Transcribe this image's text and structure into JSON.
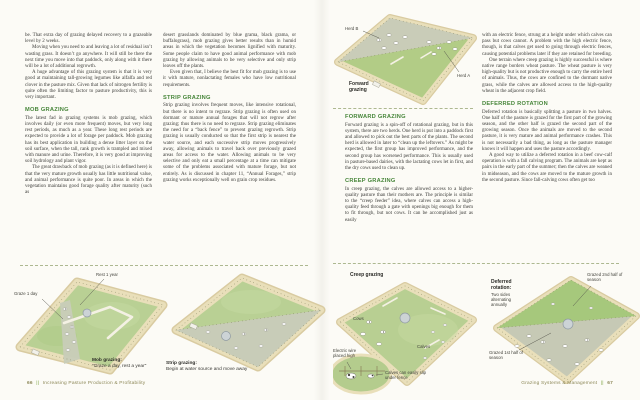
{
  "left_page": {
    "column1": {
      "p1": "be. That extra day of grazing delayed recovery to a grazeable level by 2 weeks.",
      "p2": "Moving when you need to and leaving a lot of residual isn’t wasting grass. It doesn’t go anywhere. It will still be there the next time you move into that paddock, only along with it there will be a lot of additional regrowth.",
      "p3": "A huge advantage of this grazing system is that it is very good at maintaining tall-growing legumes like alfalfa and red clover in the pasture mix. Given that lack of nitrogen fertility is quite often the limiting factor to pasture productivity, this is very important.",
      "heading": "MOB GRAZING",
      "p4": "The latest fad in grazing systems is mob grazing, which involves daily (or even more frequent) moves, but very long rest periods, as much as a year. These long rest periods are expected to provide a lot of forage per paddock. Mob grazing has its best application in building a dense litter layer on the soil surface, when the tall, rank growth is trampled and mixed with manure and urine. Therefore, it is very good at improving soil hydrology and plant vigor.",
      "p5": "The great drawback of mob grazing (as it is defined here) is that the very mature growth usually has little nutritional value, and animal performance is quite poor. In areas in which the vegetation maintains good forage quality after maturity (such as"
    },
    "column2": {
      "p1": "desert grasslands dominated by blue grama, black grama, or buffalograss), mob grazing gives better results than in humid areas in which the vegetation becomes lignified with maturity. Some people claim to have good animal performance with mob grazing by allowing animals to be very selective and only strip leaves off the plants.",
      "p2": "Even given that, I believe the best fit for mob grazing is to use it with mature, nonlactating females who have low nutritional requirements.",
      "heading": "STRIP GRAZING",
      "p3": "Strip grazing involves frequent moves, like intensive rotational, but there is no intent to regraze. Strip grazing is often used on dormant or mature annual forages that will not regrow after grazing; thus there is no need to regraze. Strip grazing eliminates the need for a “back fence” to prevent grazing regrowth. Strip grazing is usually conducted so that the first strip is nearest the water source, and each successive strip moves progressively away, allowing animals to travel back over previously grazed areas for access to the water. Allowing animals to be very selective and only eat a small percentage at a time can mitigate some of the problems associated with mature forage, but not entirely. As is discussed in chapter 11, “Annual Forages,” strip grazing works exceptionally well on grain crop residues."
    },
    "figures": {
      "mob": {
        "label_graze": "Graze 1 day",
        "label_rest": "Rest 1 year",
        "caption_title": "Mob grazing:",
        "caption_sub": "“Graze a day, rest a year”"
      },
      "strip": {
        "caption_title": "Strip grazing:",
        "caption_sub": "Begin at water source and move away"
      }
    },
    "footer": {
      "page_number": "66",
      "separator": "||",
      "book_title": "Increasing Pasture Production & Profitability"
    }
  },
  "right_page": {
    "column1": {
      "heading1": "FORWARD GRAZING",
      "p1": "Forward grazing is a spin-off of rotational grazing, but in this system, there are two herds. One herd is put into a paddock first and allowed to pick out the best parts of the plants. The second herd is allowed in later to “clean up the leftovers.” As might be expected, the first group has improved performance, and the second group has worsened performance. This is usually used in pasture-based dairies, with the lactating cows let in first, and the dry cows used to clean up.",
      "heading2": "CREEP GRAZING",
      "p2": "In creep grazing, the calves are allowed access to a higher-quality pasture than their mothers are. The principle is similar to the “creep feeder” idea, where calves can access a high-quality feed through a gate with openings big enough for them to fit through, but not cows. It can be accomplished just as easily"
    },
    "column2": {
      "p1": "with an electric fence, strung at a height under which calves can pass but cows cannot. A problem with the high electric fence, though, is that calves get used to going through electric fences, causing potential problems later if they are retained for breeding.",
      "p2": "One terrain where creep grazing is highly successful is where native range borders wheat pasture. The wheat pasture is very high-quality but is not productive enough to carry the entire herd of animals. Thus, the cows are confined to the dormant native grass, while the calves are allowed access to the high-quality wheat in the adjacent crop field.",
      "heading": "DEFERRED ROTATION",
      "p3": "Deferred rotation is basically splitting a pasture in two halves. One half of the pasture is grazed for the first part of the growing season, and the other half is grazed the second part of the growing season. Once the animals are moved to the second pasture, it is very mature and animal performance crashes. This is not necessarily a bad thing, as long as the pasture manager knows it will happen and uses the pasture accordingly.",
      "p4": "A good way to utilize a deferred rotation in a beef cow-calf operation is with a fall calving program. The animals are kept as pairs in the early part of the summer; then the calves are weaned in midseason, and the cows are moved to the mature growth in the second pasture. Since fall-calving cows often get too"
    },
    "figures": {
      "forward": {
        "herd_b": "Herd B",
        "herd_a": "Herd A",
        "caption": "Forward grazing"
      },
      "creep": {
        "title": "Creep grazing",
        "cows": "Cows",
        "calves": "Calves",
        "inset_wire": "Electric wire placed high",
        "inset_slip": "Calves can easily slip under fence"
      },
      "deferred": {
        "title": "Deferred rotation:",
        "subtitle": "Two sides alternating annually",
        "label_second": "Grazed 2nd half of season",
        "label_first": "Grazed 1st half of season"
      }
    },
    "footer": {
      "chapter_title": "Grazing Systems & Management",
      "separator": "||",
      "page_number": "67"
    }
  }
}
